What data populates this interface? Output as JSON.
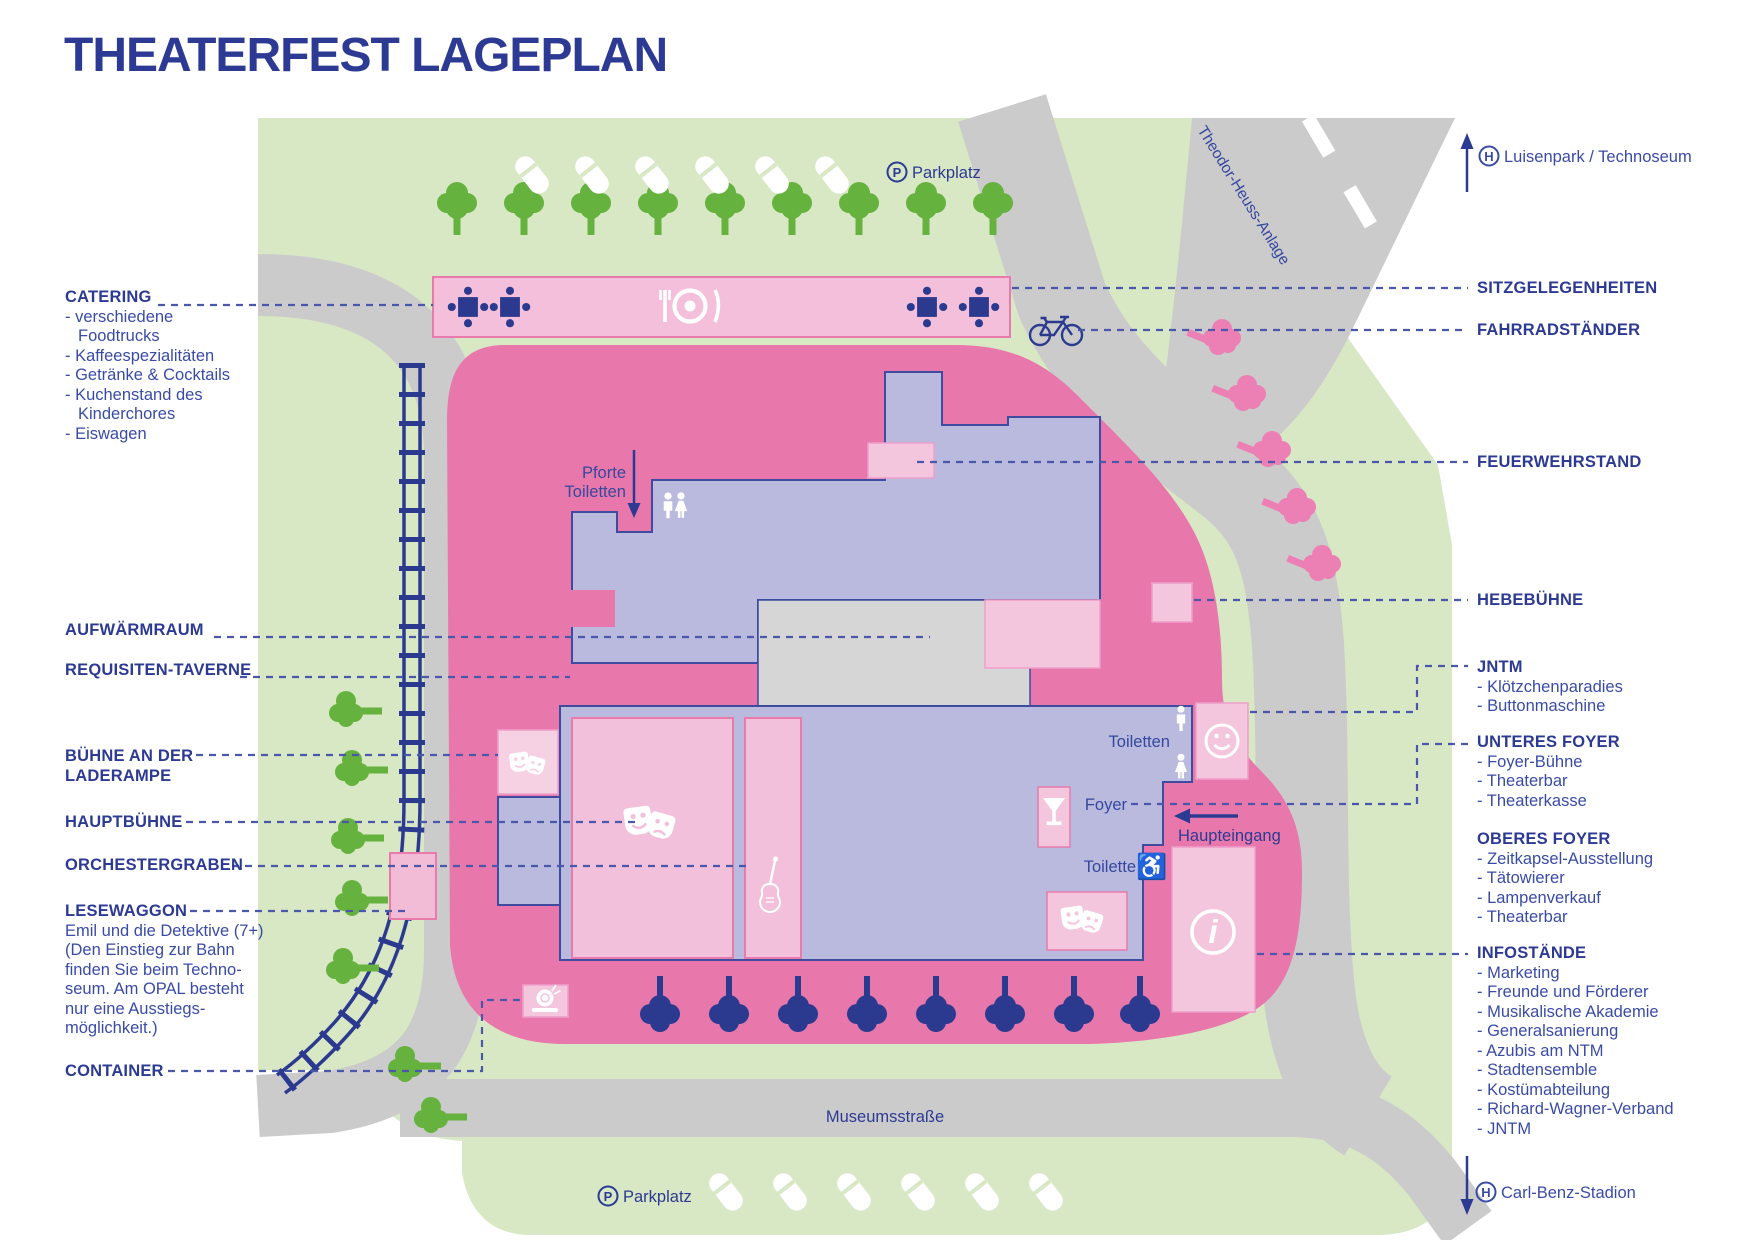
{
  "title": "THEATERFEST LAGEPLAN",
  "colors": {
    "navy": "#2c3a94",
    "label_blue": "#3a4ba6",
    "park_green": "#d8e7c4",
    "tree_green": "#66b23e",
    "road_gray": "#cbcbcb",
    "festival_pink": "#e878ab",
    "light_pink": "#f3c6de",
    "building_lavender": "#b9badd",
    "tree_pink": "#ec7fb4",
    "tree_navy": "#2b3a8f"
  },
  "left_labels": {
    "catering": {
      "title": "CATERING",
      "items": [
        "- verschiedene Foodtrucks",
        "- Kaffeespezialitäten",
        "- Getränke & Cocktails",
        "- Kuchenstand des Kinderchores",
        "- Eiswagen"
      ]
    },
    "aufwaermraum": "AUFWÄRMRAUM",
    "requisiten_taverne": "REQUISITEN-TAVERNE",
    "buehne_laderampe": "BÜHNE AN DER LADERAMPE",
    "hauptbuehne": "HAUPTBÜHNE",
    "orchestergraben": "ORCHESTERGRABEN",
    "lesewaggon": {
      "title": "LESEWAGGON",
      "lines": [
        "Emil und die Detektive (7+)",
        "(Den Einstieg zur Bahn",
        "finden Sie beim Techno-",
        "seum. Am OPAL besteht",
        "nur eine Ausstiegs-",
        "möglichkeit.)"
      ]
    },
    "container": "CONTAINER"
  },
  "right_labels": {
    "luisenpark": "Luisenpark / Technoseum",
    "sitzgelegenheiten": "SITZGELEGENHEITEN",
    "fahrradstaender": "FAHRRADSTÄNDER",
    "feuerwehrstand": "FEUERWEHRSTAND",
    "hebebuehne": "HEBEBÜHNE",
    "jntm": {
      "title": "JNTM",
      "items": [
        "- Klötzchenparadies",
        "- Buttonmaschine"
      ]
    },
    "unteres_foyer": {
      "title": "UNTERES FOYER",
      "items": [
        "- Foyer-Bühne",
        "- Theaterbar",
        "- Theaterkasse"
      ]
    },
    "oberes_foyer": {
      "title": "OBERES FOYER",
      "items": [
        "- Zeitkapsel-Ausstellung",
        "- Tätowierer",
        "- Lampenverkauf",
        "- Theaterbar"
      ]
    },
    "infostaende": {
      "title": "INFOSTÄNDE",
      "items": [
        "- Marketing",
        "- Freunde und Förderer",
        "- Musikalische Akademie",
        "- Generalsanierung",
        "- Azubis am NTM",
        "- Stadtensemble",
        "- Kostümabteilung",
        "- Richard-Wagner-Verband",
        "- JNTM"
      ]
    },
    "carl_benz": "Carl-Benz-Stadion"
  },
  "map_labels": {
    "parkplatz_top": "Parkplatz",
    "parkplatz_bottom": "Parkplatz",
    "museumsstrasse": "Museumsstraße",
    "theodor_heuss": "Theodor-Heuss-Anlage",
    "pforte_line1": "Pforte",
    "pforte_line2": "Toiletten",
    "toiletten": "Toiletten",
    "foyer": "Foyer",
    "haupteingang": "Haupteingang",
    "toilette": "Toilette"
  },
  "icons": {
    "p_badge": "P",
    "h_badge": "H",
    "info_glyph": "i"
  }
}
